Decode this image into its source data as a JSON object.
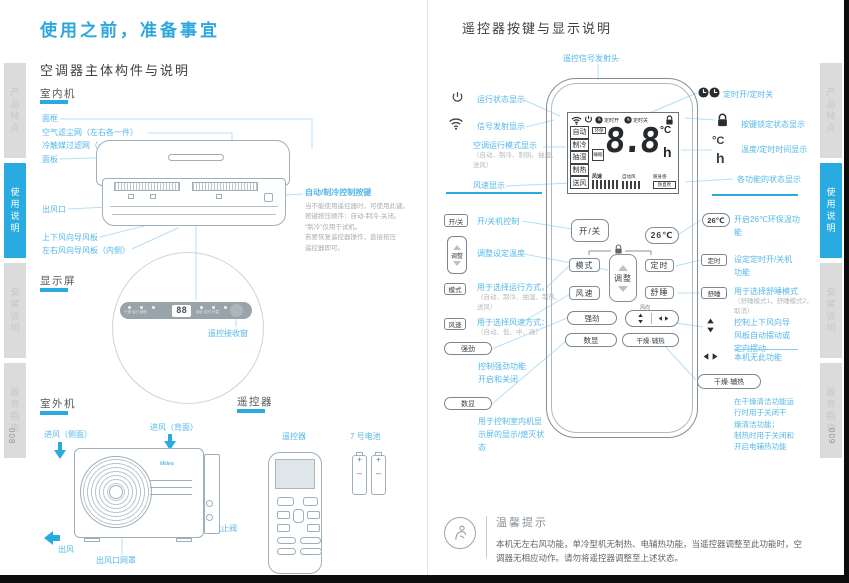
{
  "tabs": {
    "t0": "产品特点",
    "t1": "使用说明",
    "t2": "安装说明",
    "t3": "服务指南"
  },
  "page_numbers": {
    "left": "008",
    "right": "009"
  },
  "left": {
    "title": "使用之前，准备事宜",
    "heading": "空调器主体构件与说明",
    "indoor_heading": "室内机",
    "lbl_frame": "面框",
    "lbl_filter": "空气滤尘网（左右各一件）",
    "lbl_catalyst": "冷触媒过滤网（一件）",
    "lbl_panel": "面板",
    "lbl_outlet": "出风口",
    "lbl_vflap": "上下风向导风板",
    "lbl_hflap": "左右风向导风板（内侧）",
    "auto_key": "自动/制冷控制按键",
    "auto_note": "当不能使用遥控器时，可使用此键。\n按键按压顺序：自动-制冷-关闭。\n“制冷”仅用于试机。\n若要恢复遥控器操作，直接按压\n遥控器即可。",
    "display_heading": "显示屏",
    "display_digits": "88",
    "display_marks_left": "干燥 运行 辅热",
    "display_marks_right": "强劲 定时 化霜",
    "receiver": "遥控接收窗",
    "outdoor_heading": "室外机",
    "inlet_side": "进风（侧面）",
    "inlet_back": "进风（背面）",
    "valve": "截止阀",
    "outflow": "出风",
    "outlet_grille": "出风口网罩",
    "brand": "Midea",
    "remote_heading": "遥控器",
    "remote_label": "遥控器",
    "battery_label": "7 号电池"
  },
  "right": {
    "title": "遥控器按键与显示说明",
    "emitter": "遥控信号发射头",
    "lcd": {
      "timer_on": "定时开",
      "timer_off": "定时关",
      "m0": "自动",
      "m1": "制冷",
      "m2": "抽湿",
      "m3": "制热",
      "m4": "送风",
      "eco": "环保",
      "sleep": "睡眠",
      "digits": "8.8",
      "deg": "°C",
      "hour": "h",
      "fan": "风速",
      "auto_fan": "自动风",
      "follow": "随身感",
      "nodirect": "防直吹"
    },
    "n_run": "运行状态显示",
    "n_signal": "信号发射显示",
    "n_mode": "空调运行模式显示",
    "n_mode_sub": "（自动、制冷、制热、抽湿、\n送风）",
    "n_fan": "风速显示",
    "b_power": "开/关",
    "b_power_desc": "开/关机控制",
    "b_adjust": "调整",
    "b_adjust_desc": "调整设定温度",
    "b_mode": "模式",
    "b_mode_desc": "用于选择运行方式，",
    "b_mode_sub": "（自动、制冷、抽湿、制热、\n送风）",
    "b_fan": "风速",
    "b_fan_desc": "用于选择风速方式：",
    "b_fan_sub": "（自动、低、中、高）",
    "b_turbo": "强劲",
    "b_turbo_desc": "控制强劲功能\n开启和关闭",
    "b_disp": "数显",
    "b_disp_desc": "用于控制室内机显\n示屏的显示/熄灭状\n态",
    "b_timer": "定时",
    "b_sleep": "舒睡",
    "b_dry": "干燥·辅热",
    "swing_label": "风向",
    "r_timer_icons": "定时开/定时关",
    "r_lock": "按键锁定状态显示",
    "r_temp": "温度/定时时间显示",
    "r_status": "各功能的状态显示",
    "b_26": "26℃",
    "b_26_desc": "开启26℃环保温功\n能",
    "b_timer_desc": "设定定时开/关机\n功能",
    "b_sleep_desc": "用于选择舒睡模式",
    "b_sleep_sub": "（舒睡模式1，舒睡模式2，\n取消）",
    "swing_ud_desc": "控制上下风向导\n风板自动摆动或\n定向摆动",
    "swing_lr_desc": "本机无此功能",
    "b_dry_desc": "在干燥清洁功能运\n行时用于关闭干\n燥清洁功能；\n制热时用于关闭和\n开启电辅热功能",
    "tips_title": "温馨提示",
    "tips_body": "本机无左右风功能，单冷型机无制热、电辅热功能，当遥控器调整至此功能时，空\n调器无相应动作。请勿将遥控器调整至上述状态。"
  }
}
